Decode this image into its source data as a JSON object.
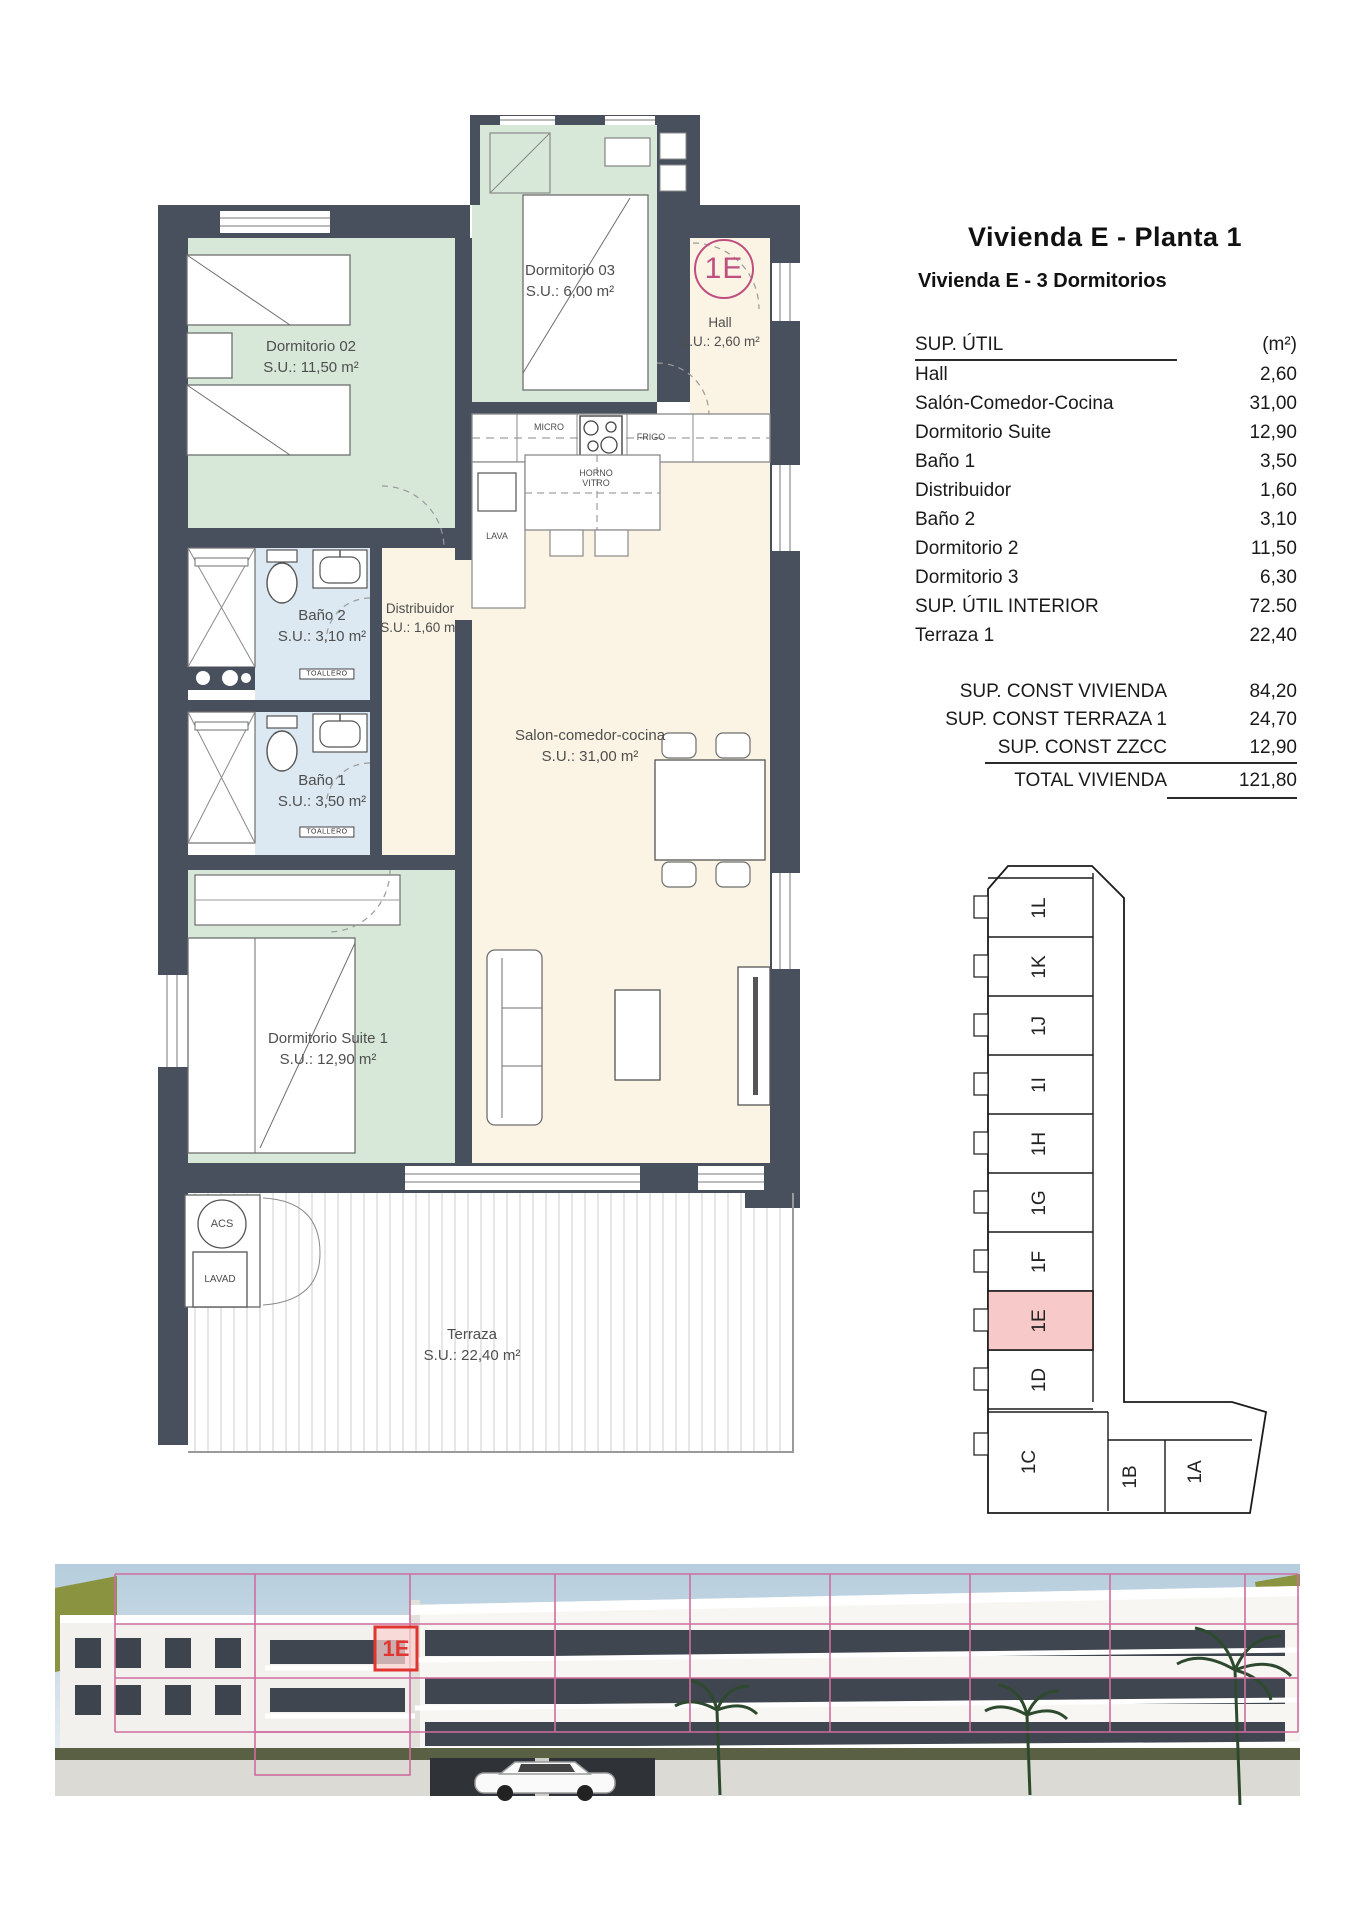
{
  "page": {
    "title": "Vivienda E - Planta 1",
    "subtitle": "Vivienda E - 3 Dormitorios"
  },
  "area_table": {
    "header": "SUP. ÚTIL",
    "unit": "(m²)",
    "rows": [
      {
        "label": "Hall",
        "value": "2,60"
      },
      {
        "label": "Salón-Comedor-Cocina",
        "value": "31,00"
      },
      {
        "label": "Dormitorio Suite",
        "value": "12,90"
      },
      {
        "label": "Baño 1",
        "value": "3,50"
      },
      {
        "label": "Distribuidor",
        "value": "1,60"
      },
      {
        "label": "Baño 2",
        "value": "3,10"
      },
      {
        "label": "Dormitorio 2",
        "value": "11,50"
      },
      {
        "label": "Dormitorio 3",
        "value": "6,30"
      },
      {
        "label": "SUP. ÚTIL INTERIOR",
        "value": "72.50"
      },
      {
        "label": "Terraza 1",
        "value": "22,40"
      }
    ],
    "summary": [
      {
        "label": "SUP. CONST VIVIENDA",
        "value": "84,20"
      },
      {
        "label": "SUP. CONST TERRAZA 1",
        "value": "24,70"
      },
      {
        "label": "SUP. CONST ZZCC",
        "value": "12,90"
      }
    ],
    "total": {
      "label": "TOTAL VIVIENDA",
      "value": "121,80"
    }
  },
  "floor_plan": {
    "badge": "1E",
    "rooms": {
      "dorm02": {
        "name": "Dormitorio 02",
        "area": "S.U.: 11,50 m²"
      },
      "dorm03": {
        "name": "Dormitorio 03",
        "area": "S.U.: 6,00 m²"
      },
      "hall": {
        "name": "Hall",
        "area": "S.U.: 2,60 m²"
      },
      "bano2": {
        "name": "Baño 2",
        "area": "S.U.: 3,10 m²"
      },
      "distribuidor": {
        "name": "Distribuidor",
        "area": "S.U.: 1,60 m²"
      },
      "bano1": {
        "name": "Baño 1",
        "area": "S.U.: 3,50 m²"
      },
      "salon": {
        "name": "Salon-comedor-cocina",
        "area": "S.U.: 31,00 m²"
      },
      "suite": {
        "name": "Dormitorio Suite 1",
        "area": "S.U.: 12,90 m²"
      },
      "terraza": {
        "name": "Terraza",
        "area": "S.U.: 22,40 m²"
      }
    },
    "fixtures": {
      "micro": "MICRO",
      "frigo": "FRIGO",
      "horno1": "HORNO",
      "horno2": "VITRO",
      "lava": "LAVA",
      "acs": "ACS",
      "lavad": "LAVAD",
      "toallero": "TOALLERO"
    }
  },
  "key_plan": {
    "highlighted_unit": "1E",
    "units_vertical": [
      "1L",
      "1K",
      "1J",
      "1I",
      "1H",
      "1G",
      "1F",
      "1E",
      "1D"
    ],
    "unit_c": "1C",
    "unit_b": "1B",
    "unit_a": "1A"
  },
  "rendering": {
    "unit_label": "1E"
  },
  "colors": {
    "wall": "#47505c",
    "bedroom_green": "#d7e8d8",
    "living_cream": "#fbf4e4",
    "bath_blue": "#dce9f2",
    "badge_pink": "#bf4f7f",
    "keyplan_highlight": "#f7c9c9",
    "render_outline": "#cf6d9d",
    "render_red": "#e03531"
  }
}
